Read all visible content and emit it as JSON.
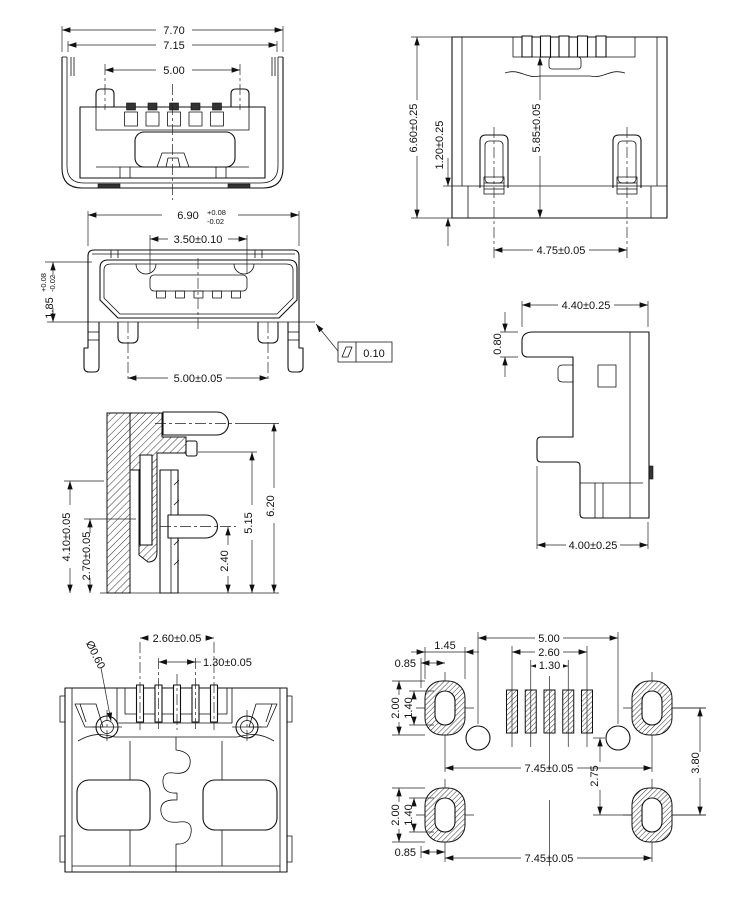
{
  "drawing": {
    "background": "#ffffff",
    "line_color": "#111111",
    "views": {
      "rear": {
        "w_outer": "7.70",
        "w_inner": "7.15",
        "w_posts": "5.00"
      },
      "top": {
        "h_overall": "6.60±0.25",
        "h_flange": "1.20±0.25",
        "h_body": "5.85±0.05",
        "w_legs": "4.75±0.05"
      },
      "front": {
        "w_shell": "6.90",
        "w_shell_tol_plus": "+0.08",
        "w_shell_tol_minus": "-0.02",
        "w_tongue": "3.50±0.10",
        "h_shell": "1.85",
        "h_shell_tol_plus": "+0.08",
        "h_shell_tol_minus": "-0.02",
        "w_posts": "5.00±0.05",
        "flatness_value": "0.10"
      },
      "side": {
        "w_top": "4.40±0.25",
        "h_step": "0.80",
        "w_bottom": "4.00±0.25"
      },
      "section": {
        "h_body": "4.10±0.05",
        "h_inner": "2.70±0.05",
        "h_pin_low": "2.40",
        "h_pin_mid": "5.15",
        "h_pin_top": "6.20"
      },
      "bottom": {
        "w_pins_outer": "2.60±0.05",
        "w_pins_inner": "1.30±0.05",
        "hole_dia": "Ø0.60"
      },
      "footprint": {
        "w_holes": "5.00",
        "w_pads_outer": "2.60",
        "w_pads_inner": "1.30",
        "pad_w": "1.45",
        "pad_offset_top": "0.85",
        "pad_h_top": "2.00",
        "hole_h_top": "1.40",
        "row_w_mid": "7.45±0.05",
        "pitch_v": "2.75",
        "row_h": "3.80",
        "pad_h_bot": "2.00",
        "hole_h_bot": "1.40",
        "pad_offset_bot": "0.85",
        "row_w_bot": "7.45±0.05"
      }
    }
  }
}
